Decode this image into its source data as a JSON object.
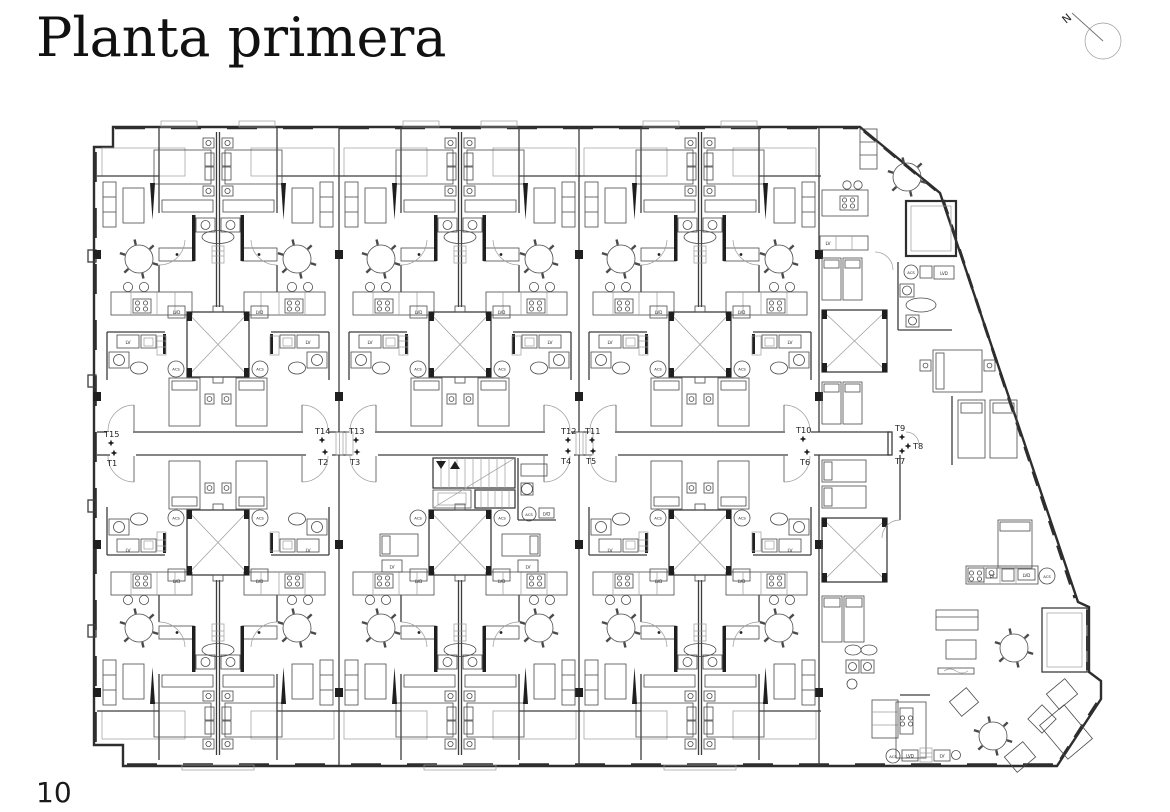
{
  "page": {
    "title": "Planta primera",
    "page_number": "10"
  },
  "compass": {
    "label": "N"
  },
  "plan": {
    "fixture_labels": {
      "lv": "LV",
      "lvd": "LVD",
      "acs": "ACS"
    },
    "unit_labels": [
      {
        "id": "T15",
        "x": 104,
        "y": 437,
        "marker": "below"
      },
      {
        "id": "T14",
        "x": 315,
        "y": 434,
        "marker": "below"
      },
      {
        "id": "T13",
        "x": 349,
        "y": 434,
        "marker": "below"
      },
      {
        "id": "T12",
        "x": 561,
        "y": 434,
        "marker": "below"
      },
      {
        "id": "T11",
        "x": 585,
        "y": 434,
        "marker": "below"
      },
      {
        "id": "T10",
        "x": 796,
        "y": 433,
        "marker": "below"
      },
      {
        "id": "T9",
        "x": 895,
        "y": 431,
        "marker": "below"
      },
      {
        "id": "T8",
        "x": 913,
        "y": 449,
        "marker": "left"
      },
      {
        "id": "T1",
        "x": 107,
        "y": 466,
        "marker": "above"
      },
      {
        "id": "T2",
        "x": 318,
        "y": 465,
        "marker": "above"
      },
      {
        "id": "T3",
        "x": 350,
        "y": 465,
        "marker": "above"
      },
      {
        "id": "T4",
        "x": 561,
        "y": 464,
        "marker": "above"
      },
      {
        "id": "T5",
        "x": 586,
        "y": 464,
        "marker": "above"
      },
      {
        "id": "T6",
        "x": 800,
        "y": 465,
        "marker": "above"
      },
      {
        "id": "T7",
        "x": 895,
        "y": 464,
        "marker": "above"
      }
    ],
    "colors": {
      "wall": "#2e2e2e",
      "furniture": "#4a4a4a",
      "light": "#9b9b9b",
      "background": "#ffffff"
    },
    "layout": {
      "module_origins_top": [
        97,
        339,
        579
      ],
      "module_origins_bottom": [
        97,
        339,
        579
      ],
      "module_width": 242,
      "corridor_y": [
        432,
        455
      ],
      "mirror_axis": 887,
      "stair_module_index": 1
    }
  }
}
